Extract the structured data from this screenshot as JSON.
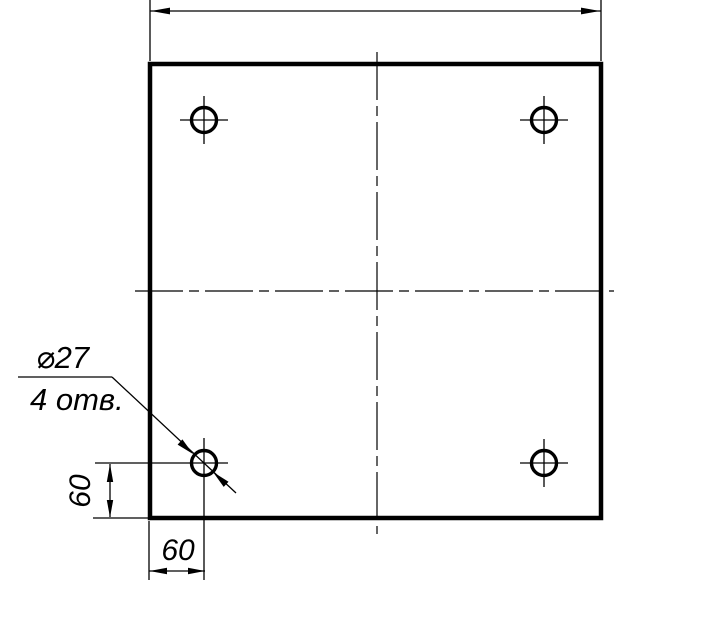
{
  "drawing": {
    "type": "technical-drawing",
    "background_color": "#ffffff",
    "line_color": "#000000",
    "part": "square plate with 4 corner holes",
    "labels": {
      "hole_diameter": "⌀27",
      "hole_count": "4 отв.",
      "dim_vertical_offset": "60",
      "dim_horizontal_offset": "60"
    }
  }
}
